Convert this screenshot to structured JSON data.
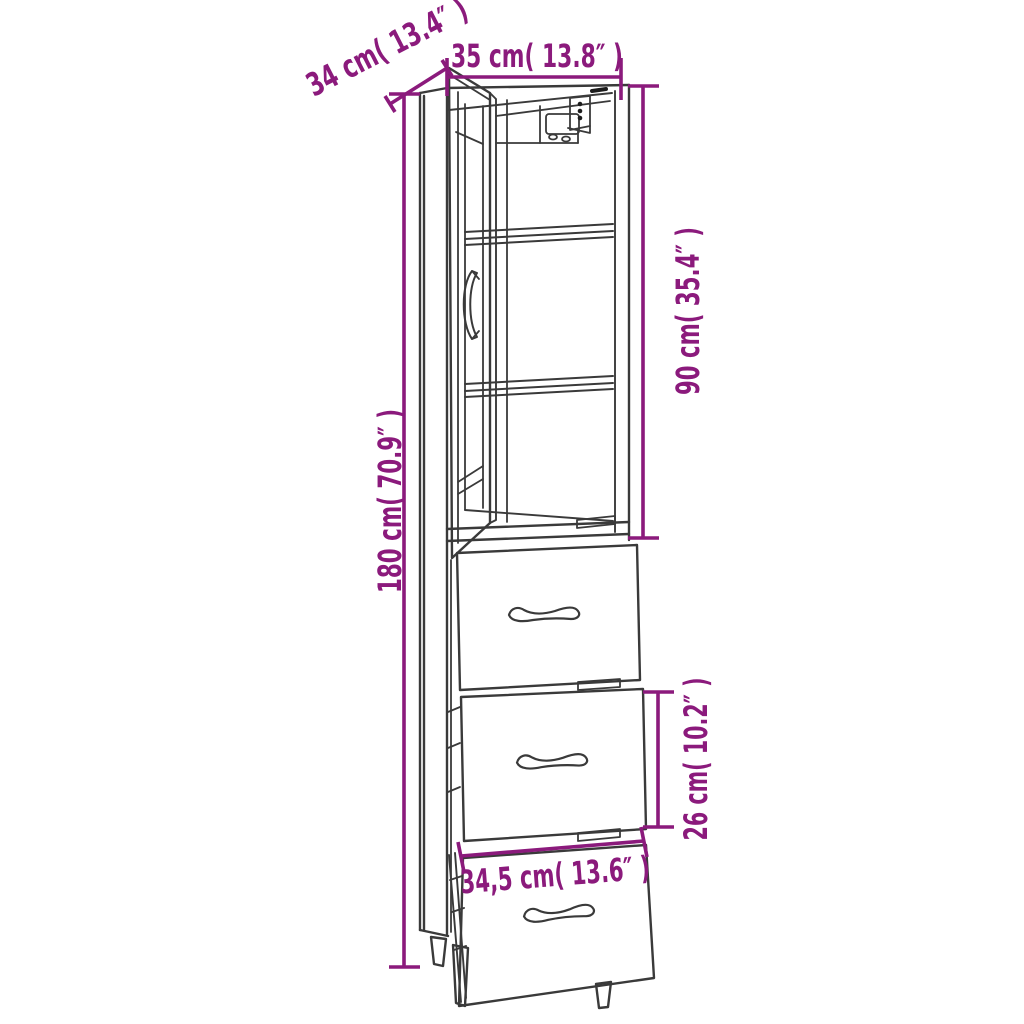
{
  "page": {
    "background": "#ffffff",
    "description": "Product dimension diagram of a tall narrow cabinet with an open glass door, interior shelves and three drawers"
  },
  "colors": {
    "dimension_annotation": "#8B1A7C",
    "line_art": "#3a3a3a",
    "detail_black": "#1c1c1c"
  },
  "diagram": {
    "type": "furniture-dimension-diagram",
    "subject": "Tall cabinet with open glass door, two shelves and three drawers (bottom drawer pulled out)",
    "dimensions": [
      {
        "id": "depth",
        "label": "34 cm( 13.4″ )",
        "cm": "34",
        "inches": "13.4"
      },
      {
        "id": "width",
        "label": "35 cm( 13.8″ )",
        "cm": "35",
        "inches": "13.8"
      },
      {
        "id": "upper-section-height",
        "label": "90 cm( 35.4″ )",
        "cm": "90",
        "inches": "35.4"
      },
      {
        "id": "total-height",
        "label": "180 cm( 70.9″ )",
        "cm": "180",
        "inches": "70.9"
      },
      {
        "id": "drawer-height",
        "label": "26 cm( 10.2″ )",
        "cm": "26",
        "inches": "10.2"
      },
      {
        "id": "drawer-width",
        "label": "34,5 cm( 13.6″ )",
        "cm": "34,5",
        "inches": "13.6"
      }
    ]
  }
}
